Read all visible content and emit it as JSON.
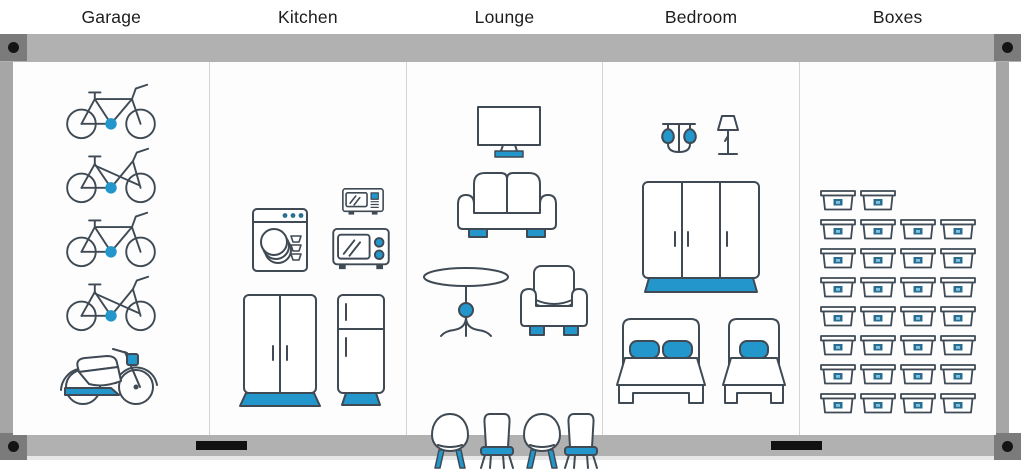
{
  "sections": [
    {
      "label": "Garage",
      "items": [
        {
          "icon": "bicycle-crossbar"
        },
        {
          "icon": "bicycle-stepthrough"
        },
        {
          "icon": "bicycle-crossbar"
        },
        {
          "icon": "bicycle-stepthrough"
        },
        {
          "icon": "motorcycle"
        }
      ]
    },
    {
      "label": "Kitchen",
      "items": [
        {
          "icon": "dishwasher"
        },
        {
          "icon": "microwave-small"
        },
        {
          "icon": "microwave-large"
        },
        {
          "icon": "kitchen-cabinet"
        },
        {
          "icon": "fridge"
        }
      ]
    },
    {
      "label": "Lounge",
      "items": [
        {
          "icon": "tv"
        },
        {
          "icon": "sofa"
        },
        {
          "icon": "round-table"
        },
        {
          "icon": "armchair"
        },
        {
          "icon": "chair-round"
        },
        {
          "icon": "chair-straight"
        },
        {
          "icon": "chair-round"
        },
        {
          "icon": "chair-straight"
        }
      ]
    },
    {
      "label": "Bedroom",
      "items": [
        {
          "icon": "ceiling-lamp"
        },
        {
          "icon": "table-lamp"
        },
        {
          "icon": "wardrobe"
        },
        {
          "icon": "bed-double"
        },
        {
          "icon": "bed-single"
        }
      ]
    },
    {
      "label": "Boxes",
      "items": [
        {
          "icon": "storage-box",
          "count": 30,
          "grid_rows": [
            2,
            4,
            4,
            4,
            4,
            4,
            4,
            4
          ]
        }
      ]
    }
  ],
  "frame": {
    "corner_bolt_count": 4,
    "handle_count": 2
  },
  "colors": {
    "accent_blue": "#2397cb",
    "line_dark": "#3f4a54",
    "box_label_blue": "#2a6f92",
    "box_label_inner": "#7fc3e0",
    "rail_gray": "#b1b1b1",
    "corner_plate_gray": "#7b7b7b",
    "bolt_black": "#141414",
    "side_rail_gray": "#a6a6a6",
    "divider_gray": "#d4d4d4",
    "label_text": "#1d1d1d"
  }
}
